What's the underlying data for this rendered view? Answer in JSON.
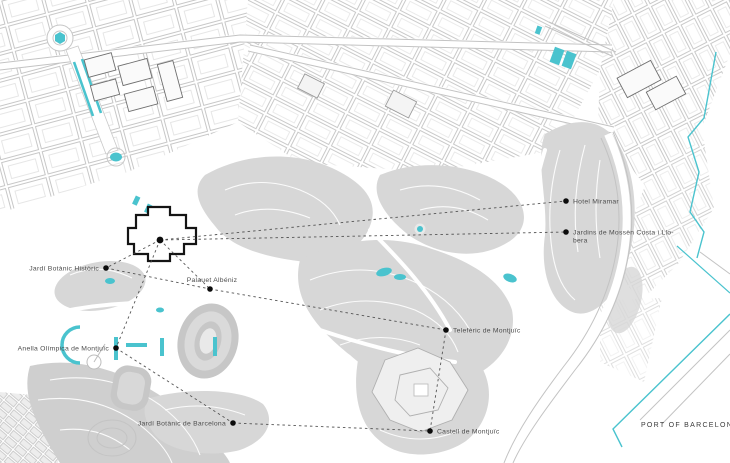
{
  "map": {
    "colors": {
      "accent": "#4ac3ce",
      "hill": "#d7d7d7",
      "street": "#c7c7c7",
      "route_line": "#4c4c4c",
      "label": "#4d4d4d",
      "poi_dot": "#0c0c0c"
    },
    "center_poi": "palau-nacional",
    "pois": [
      {
        "id": "palau-nacional",
        "x": 160,
        "y": 240,
        "label": "",
        "side": "none",
        "hub": true
      },
      {
        "id": "hotel-miramar",
        "x": 566,
        "y": 201,
        "label": "Hotel Miramar",
        "side": "right"
      },
      {
        "id": "jardins-de-mossen-costa-i-llobera",
        "x": 566,
        "y": 232,
        "lines": [
          "Jardins de Mossèn Costa i Llo-",
          "bera"
        ],
        "side": "right"
      },
      {
        "id": "jardi-botanic-historic",
        "x": 106,
        "y": 268,
        "label": "Jardí Botànic Històric",
        "side": "left"
      },
      {
        "id": "palauet-albeniz",
        "x": 210,
        "y": 289,
        "label": "Palauet Albéniz",
        "side": "above"
      },
      {
        "id": "teleferic-de-montjuic",
        "x": 446,
        "y": 330,
        "label": "Telefèric de Montjuïc",
        "side": "right"
      },
      {
        "id": "anella-olimpica-de-montjuic",
        "x": 116,
        "y": 348,
        "label": "Anella Olímpica de Montjuïc",
        "side": "left"
      },
      {
        "id": "jardi-botanic-de-barcelona",
        "x": 233,
        "y": 423,
        "label": "Jardí Botànic de Barcelona",
        "side": "left"
      },
      {
        "id": "castell-de-montjuic",
        "x": 430,
        "y": 431,
        "label": "Castell de Montjuïc",
        "side": "right"
      }
    ],
    "connections": [
      [
        "palau-nacional",
        "hotel-miramar"
      ],
      [
        "palau-nacional",
        "jardins-de-mossen-costa-i-llobera"
      ],
      [
        "palau-nacional",
        "jardi-botanic-historic"
      ],
      [
        "palau-nacional",
        "palauet-albeniz"
      ],
      [
        "palau-nacional",
        "anella-olimpica-de-montjuic"
      ],
      [
        "jardi-botanic-historic",
        "palauet-albeniz"
      ],
      [
        "palauet-albeniz",
        "teleferic-de-montjuic"
      ],
      [
        "anella-olimpica-de-montjuic",
        "jardi-botanic-de-barcelona"
      ],
      [
        "jardi-botanic-de-barcelona",
        "castell-de-montjuic"
      ],
      [
        "teleferic-de-montjuic",
        "castell-de-montjuic"
      ]
    ],
    "port_label": {
      "text": "PORT OF BARCELONA",
      "x": 690,
      "y": 427
    }
  }
}
